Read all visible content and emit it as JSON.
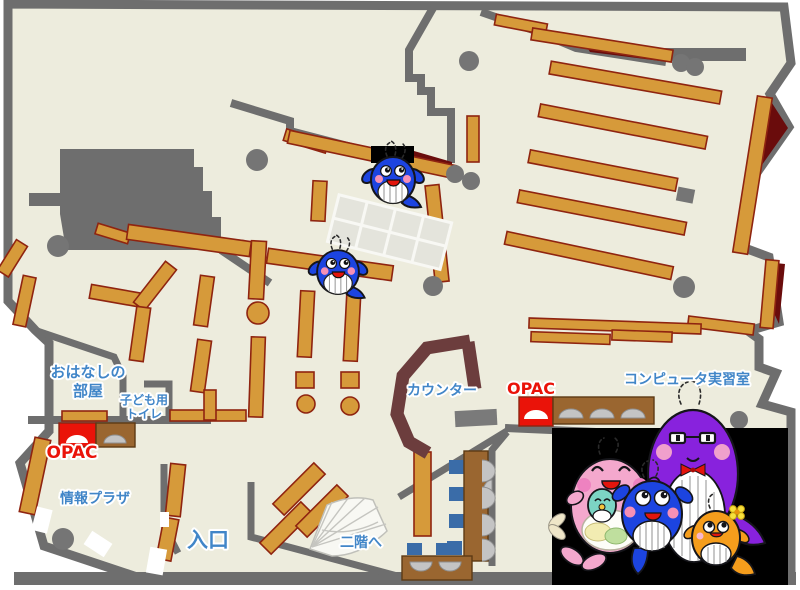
{
  "title": "library-floor-map",
  "labels": {
    "storytelling_line1": "おはなしの",
    "storytelling_line2": "部屋",
    "kids_toilet_line1": "子ども用",
    "kids_toilet_line2": "トイレ",
    "opac_left": "OPAC",
    "opac_right": "OPAC",
    "info_plaza": "情報プラザ",
    "entrance": "入口",
    "counter": "カウンター",
    "computer_room": "コンピュータ実習室",
    "stairs": "二階へ"
  },
  "colors": {
    "floor": "#edecdd",
    "wall": "#6e6e6e",
    "shelf": "#d69a3a",
    "shelf_border": "#8f2410",
    "maroon": "#6a0c0c",
    "counter": "#6c3d3d",
    "desk_brown": "#9a6630",
    "chair_blue": "#3a6ca8",
    "monitor_gray": "#c4c4c4",
    "pillar": "#757575",
    "label_blue": "#4186c8",
    "label_red": "#ea1309",
    "panel_black": "#000000",
    "whale_blue": "#1c44e0",
    "whale_purple": "#8822dd",
    "whale_pink": "#f4a8cd",
    "whale_orange": "#f59d1c",
    "whale_teal": "#7cd4c4",
    "grid_cell": "#e4e4dc"
  }
}
